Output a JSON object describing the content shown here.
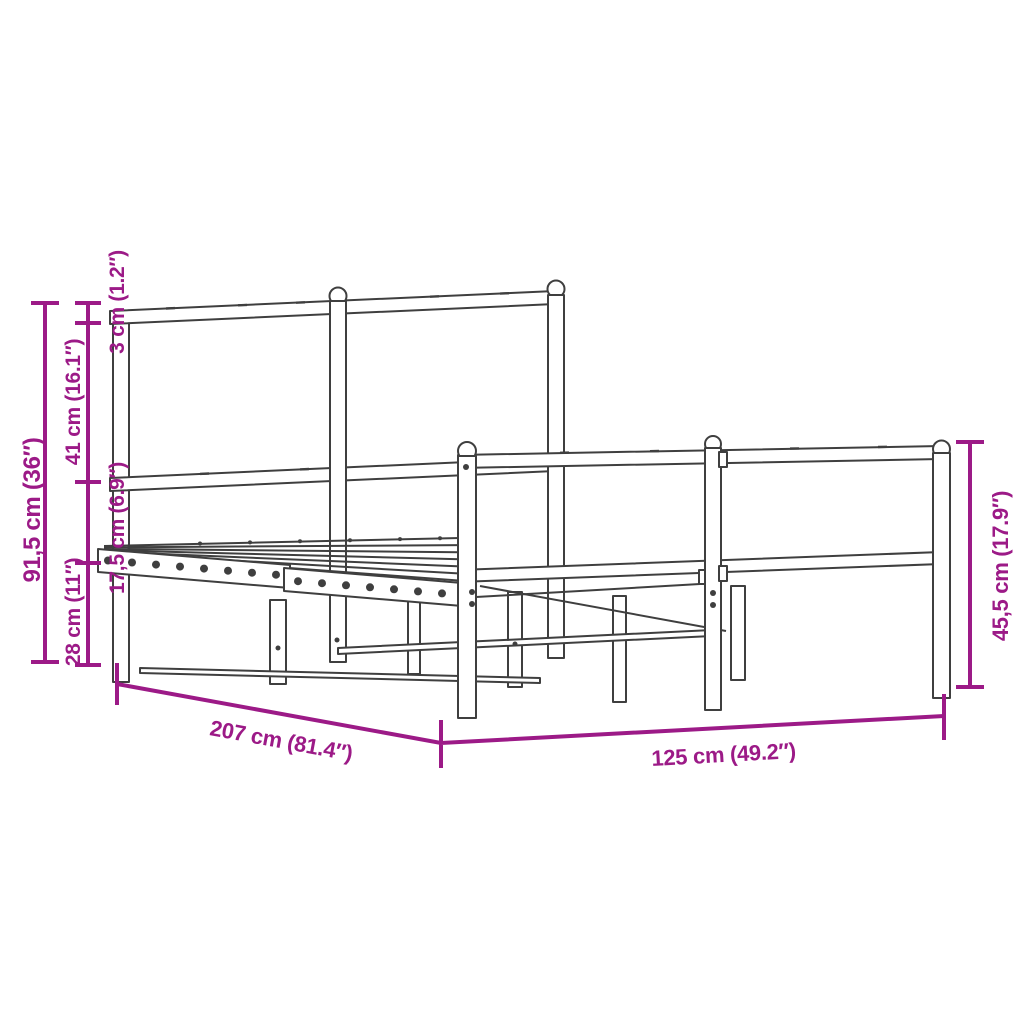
{
  "diagram": {
    "title": "bed frame dimension diagram",
    "colors": {
      "dimension": "#9c1a87",
      "line_art": "#3f3f3f",
      "background": "#ffffff"
    },
    "labels": {
      "total_height": "91,5 cm (36″)",
      "upper_section": "41 cm (16.1″)",
      "tube_thickness": "3 cm (1.2″)",
      "mid_section": "17,5 cm (6.9″)",
      "lower_section": "28 cm (11″)",
      "length": "207 cm (81.4″)",
      "width": "125 cm (49.2″)",
      "footboard_height": "45,5 cm (17.9″)"
    }
  }
}
